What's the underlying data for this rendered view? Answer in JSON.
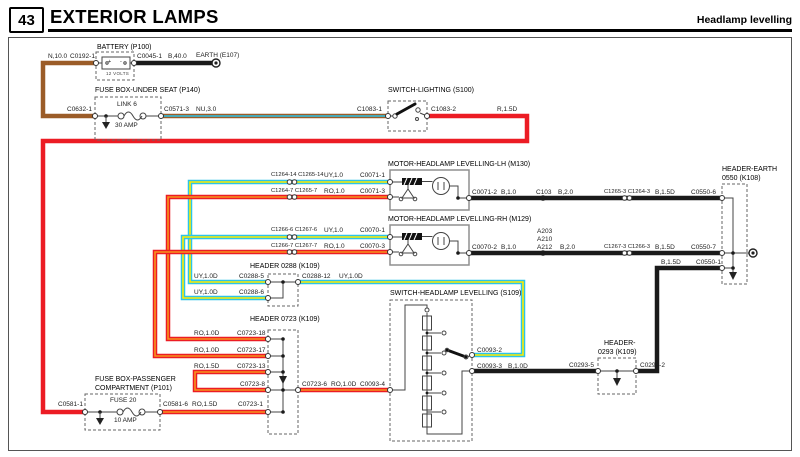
{
  "colors": {
    "brown": "#9b5c28",
    "red": "#ec1c24",
    "orange": "#f7941d",
    "cyan": "#2cc4e8",
    "yellow": "#ffec00",
    "blackw": "#1a1a1a",
    "line": "#555"
  },
  "header": {
    "page_num": "43",
    "title": "EXTERIOR LAMPS",
    "subtitle": "Headlamp levelling"
  },
  "battery": {
    "title": "BATTERY (P100)",
    "wire_in": "N,10.0",
    "conn_in": "C0192-1",
    "conn_out": "C0045-1",
    "wire_out": "B,40.0",
    "earth_label": "EARTH (E107)",
    "volts": "12 VOLTS",
    "plus": "+",
    "minus": "-"
  },
  "fusebox_underseat": {
    "title": "FUSE BOX-UNDER SEAT (P140)",
    "conn_in": "C0632-1",
    "link_label": "LINK 6",
    "amp_label": "30 AMP",
    "conn_out": "C0571-3",
    "wire_out": "NU,3.0"
  },
  "switch_lighting": {
    "title": "SWITCH-LIGHTING (S100)",
    "conn_in": "C1083-1",
    "conn_out": "C1083-2",
    "wire_out": "R,1.5D"
  },
  "motor_lh": {
    "title": "MOTOR-HEADLAMP LEVELLING-LH (M130)",
    "signal_conns": "C1264-14 C1265-14",
    "signal_wire": "UY,1.0",
    "signal_pin": "C0071-1",
    "supply_conns": "C1264-7 C1265-7",
    "supply_wire": "RO,1.0",
    "supply_pin": "C0071-3",
    "earth_pin": "C0071-2",
    "earth_wire_1": "B,1.0",
    "splice": "C103",
    "earth_wire_2": "B,2.0",
    "earth_conns": "C1265-3 C1264-3",
    "earth_wire_3": "B,1.5D",
    "earth_dest": "C0550-6"
  },
  "motor_rh": {
    "title": "MOTOR-HEADLAMP LEVELLING-RH (M129)",
    "signal_conns": "C1266-6 C1267-6",
    "signal_wire": "UY,1.0",
    "signal_pin": "C0070-1",
    "supply_conns": "C1266-7 C1267-7",
    "supply_wire": "RO,1.0",
    "supply_pin": "C0070-3",
    "earth_pin": "C0070-2",
    "earth_wire_1": "B,1.0",
    "splices": [
      "A203",
      "A210",
      "A212"
    ],
    "earth_wire_2": "B,2.0",
    "earth_conns": "C1267-3 C1266-3",
    "earth_wire_3": "B,1.5D",
    "earth_dest": "C0550-7"
  },
  "header_0288": {
    "title": "HEADER 0288 (K109)",
    "row1_wire": "UY,1.0D",
    "row1_pin": "C0288-5",
    "row2_wire": "UY,1.0D",
    "row2_pin": "C0288-6",
    "out_pin": "C0288-12",
    "out_wire": "UY,1.0D"
  },
  "header_0723": {
    "title": "HEADER 0723 (K109)",
    "row1_wire": "RO,1.0D",
    "row1_pin": "C0723-18",
    "row2_wire": "RO,1.0D",
    "row2_pin": "C0723-17",
    "row3_wire": "RO,1.5D",
    "row3_pin": "C0723-13",
    "jumper_pin": "C0723-8",
    "out_pin": "C0723-6",
    "out_wire": "RO,1.0D",
    "out_dest": "C0093-4"
  },
  "switch_levelling": {
    "title": "SWITCH-HEADLAMP LEVELLING (S109)",
    "signal_pin": "C0093-2",
    "earth_pin": "C0093-3",
    "earth_wire": "B,1.0D"
  },
  "header_0293": {
    "title_line1": "HEADER-",
    "title_line2": "0293 (K109)",
    "in_pin": "C0293-5",
    "out_pin": "C0293-2",
    "out_wire": "B,1.5D",
    "out_dest": "C0550-1"
  },
  "header_earth_0550": {
    "title_line1": "HEADER-EARTH",
    "title_line2": "0550 (K108)"
  },
  "fusebox_passenger": {
    "title_line1": "FUSE BOX-PASSENGER",
    "title_line2": "COMPARTMENT (P101)",
    "conn_in": "C0581-1",
    "fuse_label": "FUSE 20",
    "amp_label": "10 AMP",
    "conn_out": "C0581-6",
    "wire_out": "RO,1.5D",
    "out_dest": "C0723-1"
  }
}
